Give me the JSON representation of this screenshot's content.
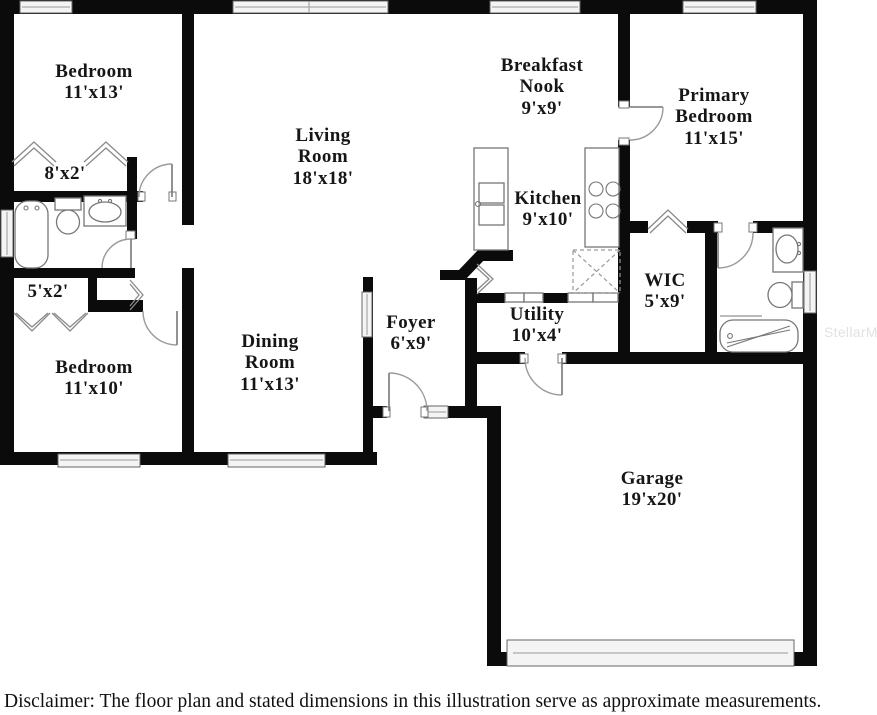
{
  "rooms": {
    "bedroom_top": {
      "label": "Bedroom",
      "dims": "11'x13'"
    },
    "closet_top": {
      "dims": "8'x2'"
    },
    "closet_hall": {
      "dims": "5'x2'"
    },
    "bedroom_bottom": {
      "label": "Bedroom",
      "dims": "11'x10'"
    },
    "living_room": {
      "label1": "Living",
      "label2": "Room",
      "dims": "18'x18'"
    },
    "dining_room": {
      "label1": "Dining",
      "label2": "Room",
      "dims": "11'x13'"
    },
    "foyer": {
      "label": "Foyer",
      "dims": "6'x9'"
    },
    "breakfast_nook": {
      "label1": "Breakfast",
      "label2": "Nook",
      "dims": "9'x9'"
    },
    "kitchen": {
      "label": "Kitchen",
      "dims": "9'x10'"
    },
    "utility": {
      "label": "Utility",
      "dims": "10'x4'"
    },
    "primary_bedroom": {
      "label1": "Primary",
      "label2": "Bedroom",
      "dims": "11'x15'"
    },
    "wic": {
      "label": "WIC",
      "dims": "5'x9'"
    },
    "garage": {
      "label": "Garage",
      "dims": "19'x20'"
    }
  },
  "footer": {
    "disclaimer": "Disclaimer: The floor plan and stated dimensions in this illustration serve as approximate measurements."
  },
  "watermark": "StellarMLS",
  "colors": {
    "wall": "#0b0b0b",
    "text": "#161616",
    "fixture_outline": "#777777",
    "watermark": "#e2e2e2"
  }
}
